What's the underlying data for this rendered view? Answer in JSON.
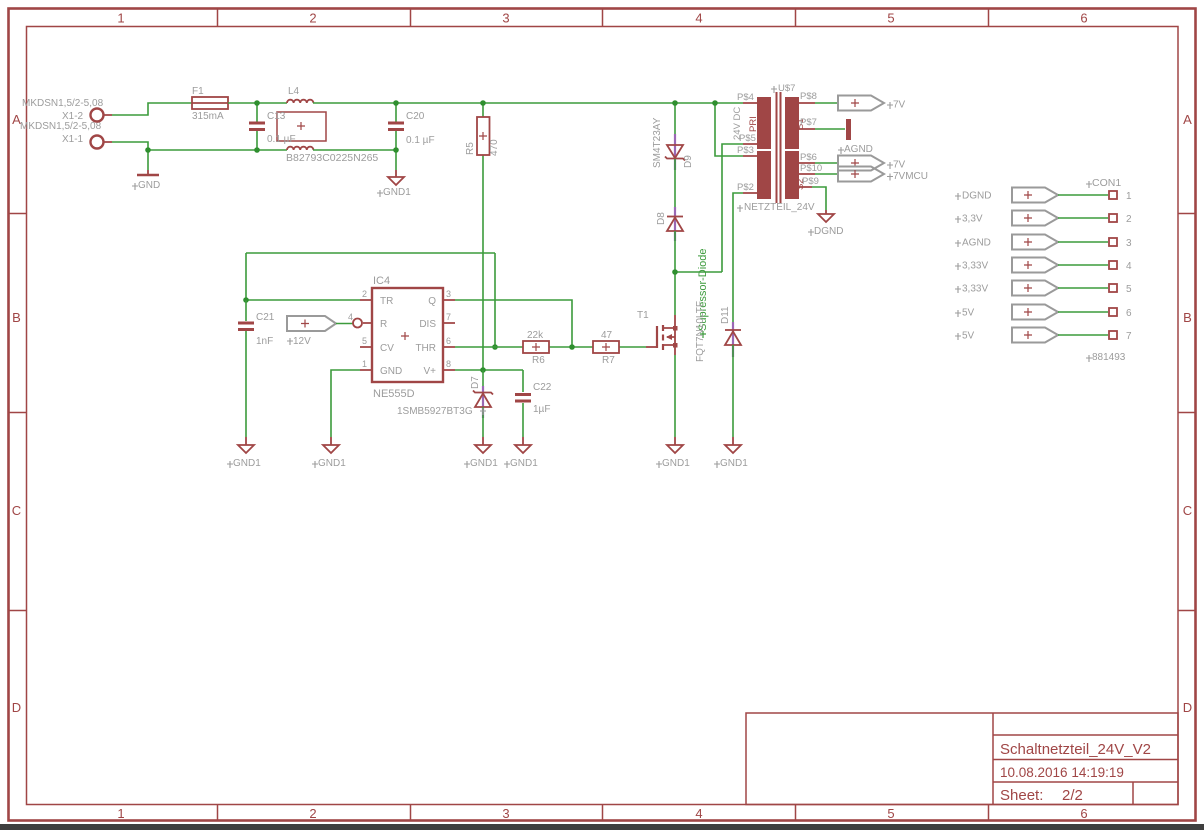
{
  "colors": {
    "symbol_red": "#a04646",
    "wire_green": "#3c9b3c",
    "junction_green": "#2f8f2f",
    "label_gray": "#9c9c9c",
    "overlay_purple": "#9a68b4"
  },
  "frame": {
    "cols": [
      "1",
      "2",
      "3",
      "4",
      "5",
      "6"
    ],
    "rows": [
      "A",
      "B",
      "C",
      "D"
    ]
  },
  "titleblock": {
    "title": "Schaltnetzteil_24V_V2",
    "date": "10.08.2016 14:19:19",
    "sheet_label": "Sheet:",
    "sheet_num": "2/2"
  },
  "labels": {
    "mkdsn": "MKDSN1,5/2-5,08",
    "x1_2": "X1-2",
    "x1_1": "X1-1",
    "gnd": "GND",
    "gnd1": "GND1",
    "dgnd": "DGND",
    "agnd": "AGND",
    "f1": "F1",
    "f1v": "315mA",
    "l4": "L4",
    "l4v": "B82793C0225N265",
    "c13": "C13",
    "c13v": "0.1 µF",
    "c20": "C20",
    "c20v": "0.1 µF",
    "r5": "R5",
    "r5v": "470",
    "c21": "C21",
    "c21v": "1nF",
    "v12": "12V",
    "ic4": "IC4",
    "ic4v": "NE555D",
    "r6": "R6",
    "r6v": "22k",
    "r7": "R7",
    "r7v": "47",
    "d7": "D7",
    "d7v": "1SMB5927BT3G",
    "c22": "C22",
    "c22v": "1µF",
    "t1": "T1",
    "t1v": "FQT7N10LTF",
    "d8": "D8",
    "d9": "D9",
    "d9v": "SM4T23AY",
    "d11": "D11",
    "suppressor": "Supressor-Diode",
    "u7": "U$7",
    "u7v": "NETZTEIL_24V",
    "pri": "PRI",
    "v24": "24V DC",
    "s1": "S1",
    "s2": "S2",
    "p4": "P$4",
    "p5": "P$5",
    "p3": "P$3",
    "p2": "P$2",
    "p8": "P$8",
    "p7": "P$7",
    "p6": "P$6",
    "p10": "P$10",
    "p9": "P$9",
    "out7v": "7V",
    "out7vmcu": "7VMCU"
  },
  "ic_pins": {
    "tr": "TR",
    "r": "R",
    "cv": "CV",
    "gnd": "GND",
    "q": "Q",
    "dis": "DIS",
    "thr": "THR",
    "vp": "V+",
    "n2": "2",
    "n4": "4",
    "n5": "5",
    "n1": "1",
    "n3": "3",
    "n7": "7",
    "n6": "6",
    "n8": "8"
  },
  "con1": {
    "name": "CON1",
    "pn": "881493",
    "rows": [
      {
        "label": "DGND",
        "pin": "1"
      },
      {
        "label": "3,3V",
        "pin": "2"
      },
      {
        "label": "AGND",
        "pin": "3"
      },
      {
        "label": "3,33V",
        "pin": "4"
      },
      {
        "label": "3,33V",
        "pin": "5"
      },
      {
        "label": "5V",
        "pin": "6"
      },
      {
        "label": "5V",
        "pin": "7"
      }
    ]
  }
}
